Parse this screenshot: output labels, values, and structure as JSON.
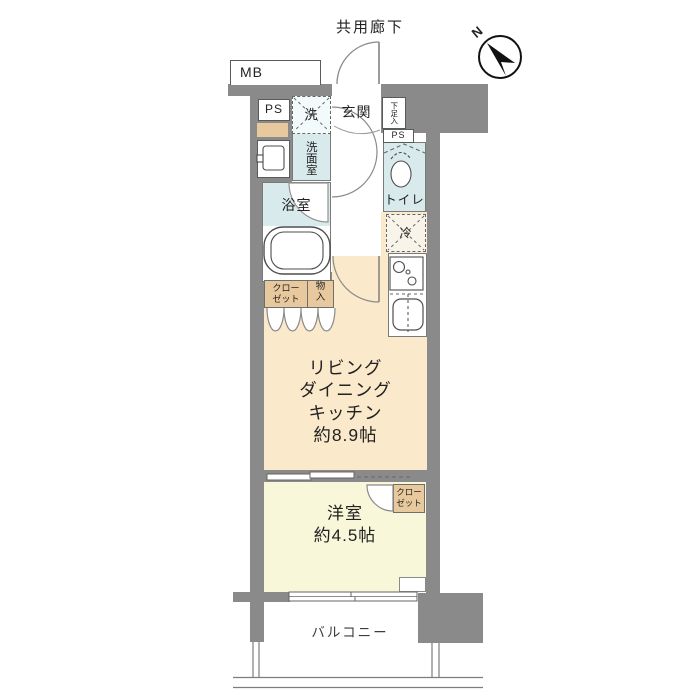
{
  "colors": {
    "wall": "#8a8a8a",
    "ldk": "#fbe9cc",
    "bedroom": "#f8f7d9",
    "wet": "#d9eaec",
    "tan": "#e8c99e",
    "washer_bg": "#f3fafb",
    "fridge_bg": "#f8f4ea"
  },
  "header": {
    "corridor": "共用廊下",
    "north": "N"
  },
  "utility": {
    "mb": "MB",
    "ps_upper": "PS",
    "ps_lower": "PS"
  },
  "rooms": {
    "genkan": "玄関",
    "washroom": "洗面室",
    "bathroom": "浴室",
    "toilet": "トイレ",
    "ldk": "リビング\nダイニング\nキッチン\n約8.9帖",
    "bedroom": "洋室\n約4.5帖",
    "balcony": "バルコニー"
  },
  "storage": {
    "shoe": "下足入",
    "closet_hall": "クロー\nゼット",
    "hall_storage": "物\n入",
    "closet_bedroom": "クロー\nゼット"
  },
  "appliances": {
    "washer": "洗",
    "fridge": "冷"
  }
}
